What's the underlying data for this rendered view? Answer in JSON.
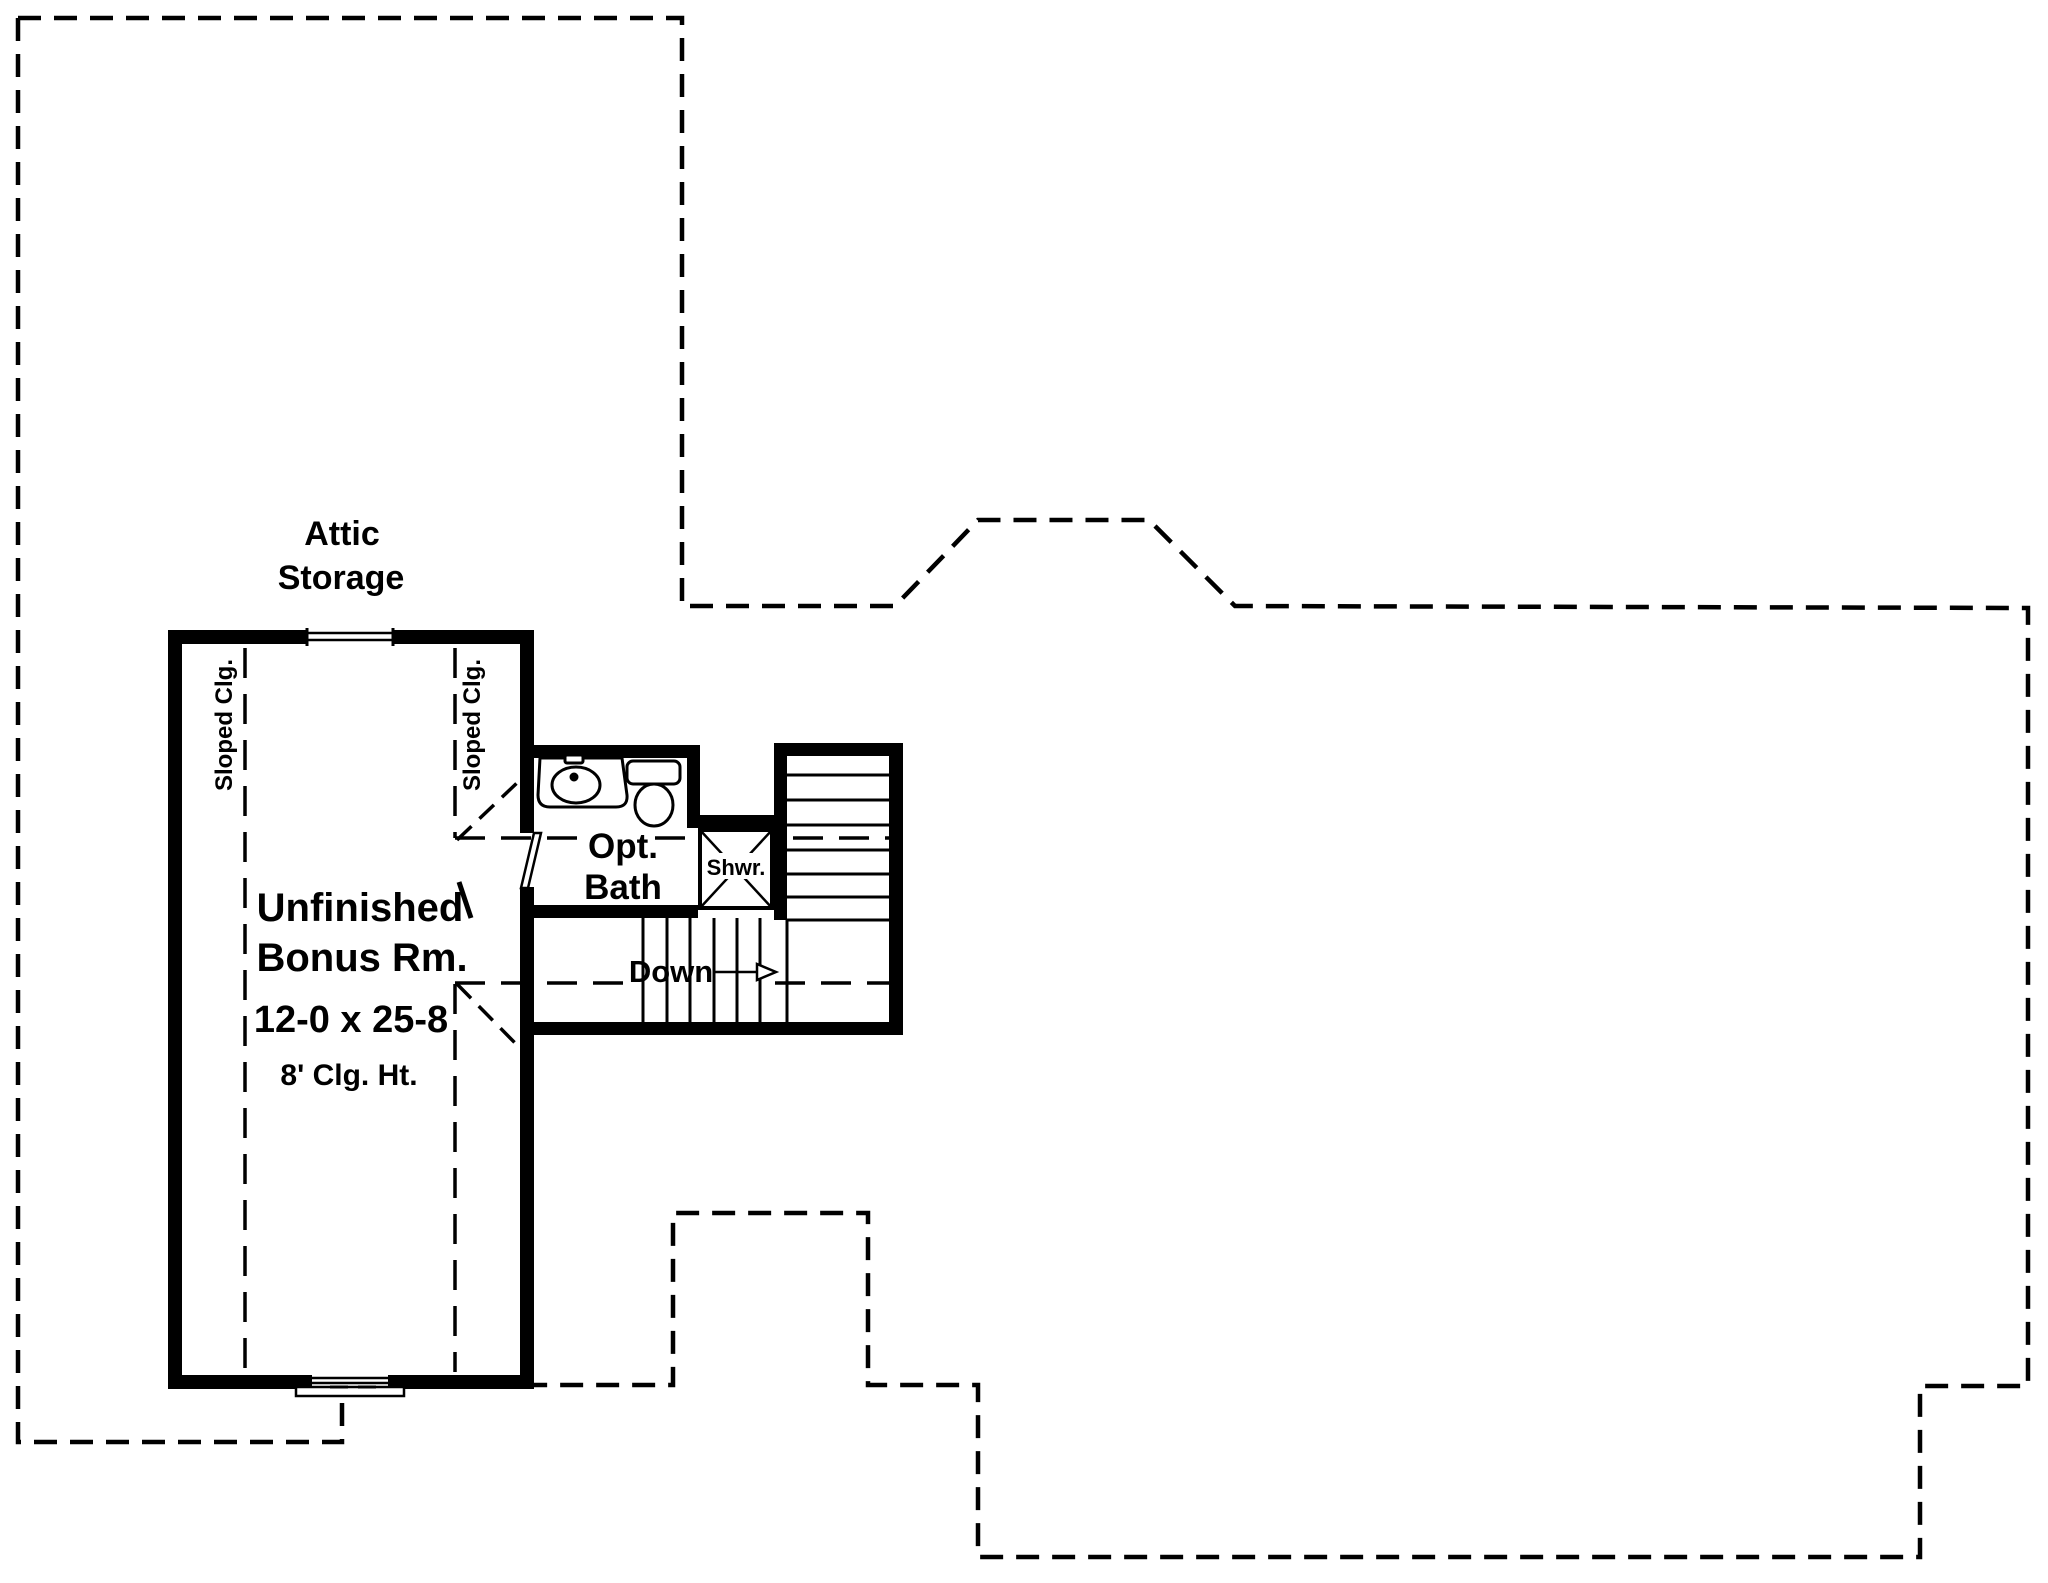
{
  "floor_plan": {
    "background_color": "#ffffff",
    "line_color": "#000000",
    "attic": {
      "line1": "Attic",
      "line2": "Storage"
    },
    "bonus_room": {
      "line1": "Unfinished",
      "line2": "Bonus Rm.",
      "dimensions": "12-0 x 25-8",
      "ceiling_height": "8' Clg. Ht.",
      "sloped_ceiling_left": "Sloped Clg.",
      "sloped_ceiling_right": "Sloped Clg."
    },
    "bath": {
      "line1": "Opt.",
      "line2": "Bath",
      "shower_label": "Shwr."
    },
    "stairs": {
      "direction_label": "Down"
    }
  }
}
